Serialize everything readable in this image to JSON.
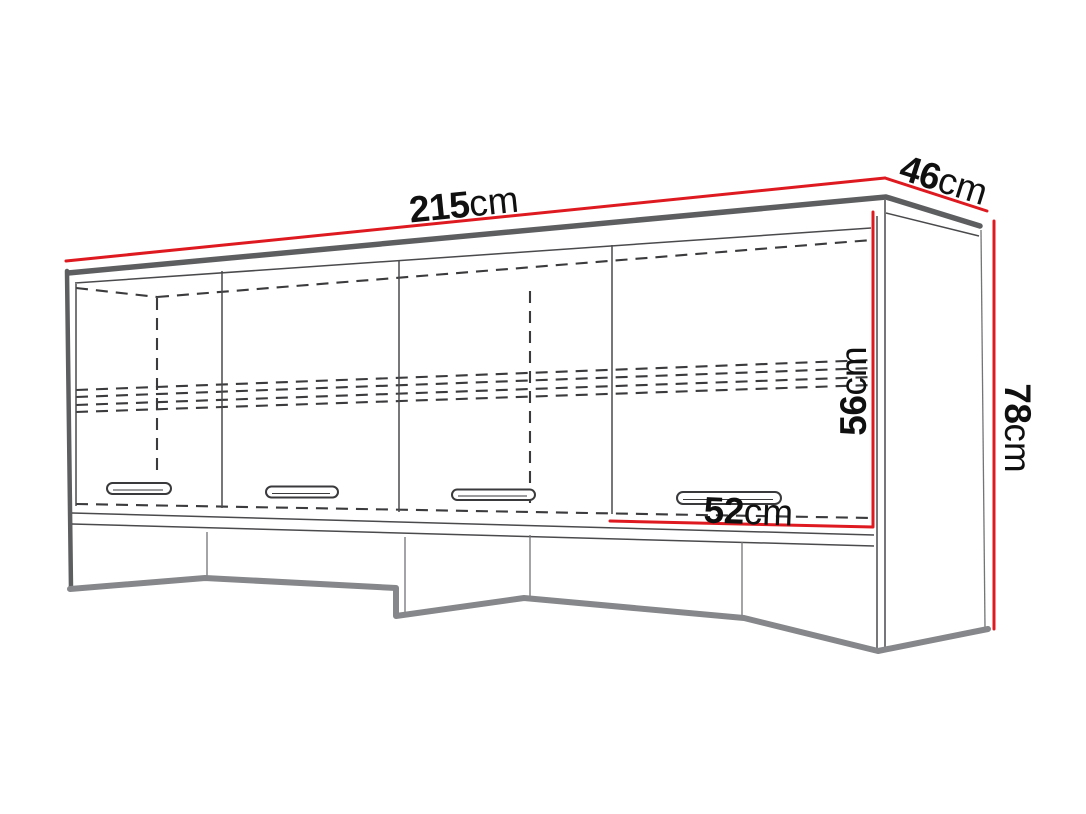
{
  "diagram": {
    "subject": "wall-mounted-over-bed-cabinet",
    "description": "Technical dimension drawing of a four-door wall-mounted over-bed cabinet shown in perspective with dashed interior shelf lines",
    "unit": "cm",
    "dimensions": {
      "width": {
        "value": "215",
        "unit": "cm"
      },
      "depth": {
        "value": "46",
        "unit": "cm"
      },
      "height": {
        "value": "78",
        "unit": "cm"
      },
      "opening_height": {
        "value": "56",
        "unit": "cm"
      },
      "door_width": {
        "value": "52",
        "unit": "cm"
      }
    },
    "colors": {
      "dimension_line": "#de1a20",
      "edge_dark": "#5d5e60",
      "shadow_edge": "#85878a",
      "line": "#4a4a4d",
      "background": "#ffffff"
    }
  }
}
